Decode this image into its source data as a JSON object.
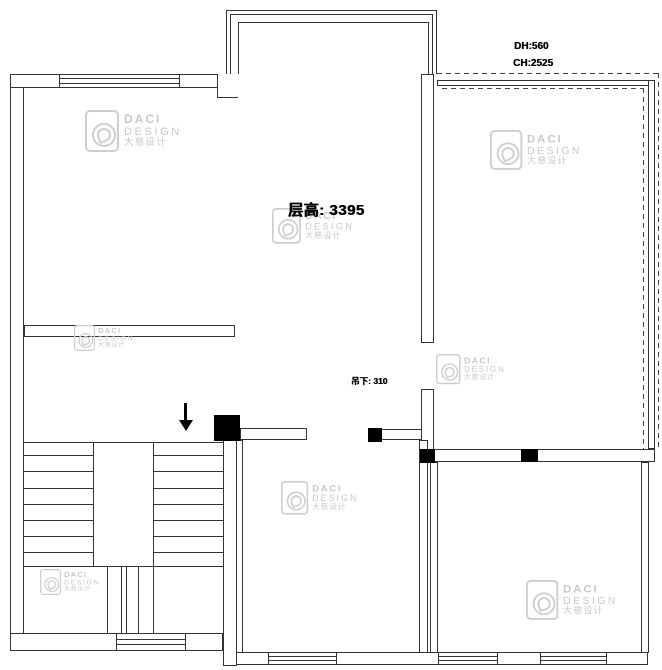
{
  "watermark": {
    "brand": "DACI",
    "subtitle": "DESIGN",
    "chinese": "大慈设计"
  },
  "annotations": {
    "floor_height": "层高: 3395",
    "dh": "DH:560",
    "ch": "CH:2525",
    "drop": "吊下: 310"
  },
  "colors": {
    "line": "#333333",
    "watermark": "#c9c9c9",
    "text": "#000000",
    "background": "#ffffff"
  }
}
